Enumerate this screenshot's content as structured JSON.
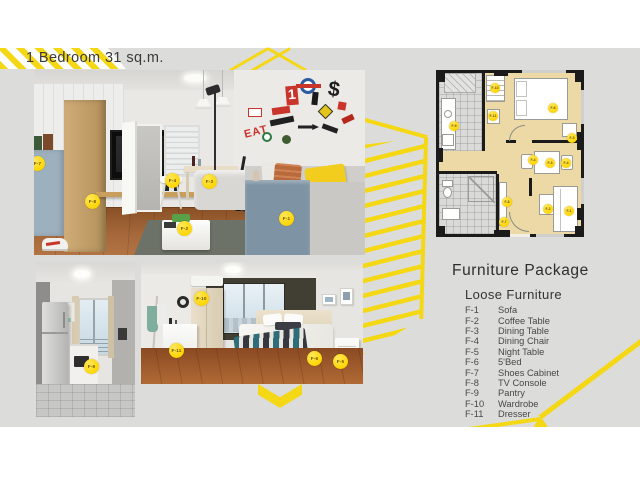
{
  "title": "1 Bedroom 31 sq.m.",
  "furniture_package": {
    "heading": "Furniture Package",
    "subheading": "Loose Furniture",
    "items": [
      {
        "code": "F-1",
        "name": "Sofa"
      },
      {
        "code": "F-2",
        "name": "Coffee Table"
      },
      {
        "code": "F-3",
        "name": "Dining Table"
      },
      {
        "code": "F-4",
        "name": "Dining Chair"
      },
      {
        "code": "F-5",
        "name": "Night Table"
      },
      {
        "code": "F-6",
        "name": "5'Bed"
      },
      {
        "code": "F-7",
        "name": "Shoes Cabinet"
      },
      {
        "code": "F-8",
        "name": "TV Console"
      },
      {
        "code": "F-9",
        "name": "Pantry"
      },
      {
        "code": "F-10",
        "name": "Wardrobe"
      },
      {
        "code": "F-11",
        "name": "Dresser"
      }
    ]
  },
  "markers": {
    "main_photo": [
      "F-7",
      "F-8",
      "F-4",
      "F-3",
      "F-2",
      "F-1"
    ],
    "kitchen_photo": [
      "F-9"
    ],
    "bedroom_photo": [
      "F-10",
      "F-11",
      "F-6",
      "F-5"
    ],
    "floor_plan": [
      "F-9",
      "F-10",
      "F-11",
      "F-6",
      "F-5",
      "F-4",
      "F-3",
      "F-4",
      "F-8",
      "F-7",
      "F-2",
      "F-1"
    ]
  },
  "wall_decals": {
    "eat": "EAT",
    "one": "1",
    "dollar": "$"
  },
  "colors": {
    "accent_yellow": "#F5D815",
    "background_gray": "#DCDCDB",
    "marker_yellow": "#FED500"
  }
}
